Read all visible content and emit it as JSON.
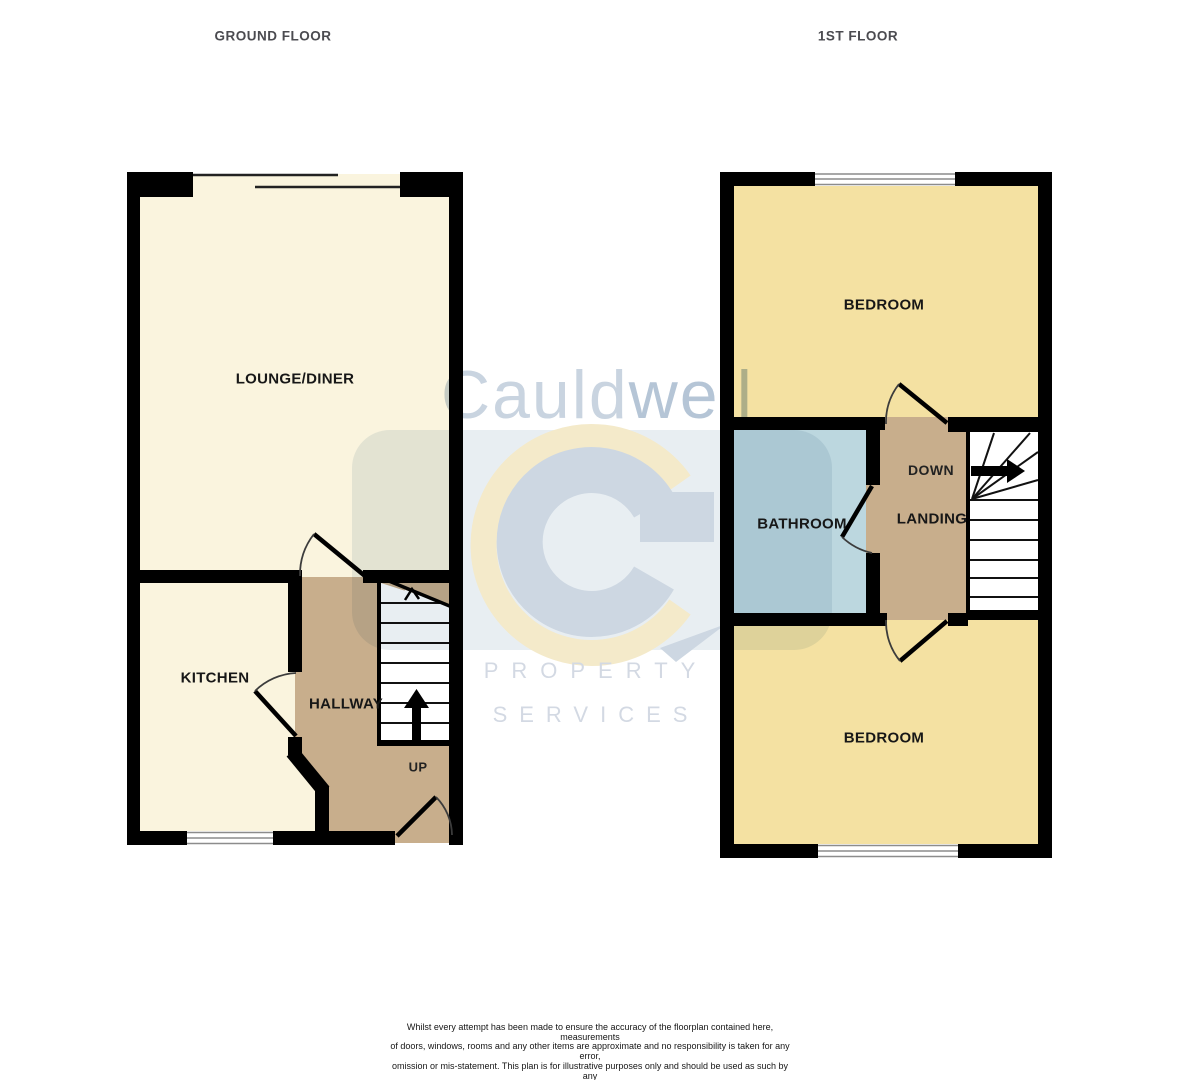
{
  "floors": {
    "ground": {
      "title": "GROUND FLOOR",
      "rooms": {
        "lounge": "LOUNGE/DINER",
        "kitchen": "KITCHEN",
        "hallway": "HALLWAY"
      },
      "stair_direction": "UP"
    },
    "first": {
      "title": "1ST FLOOR",
      "rooms": {
        "bedroom_top": "BEDROOM",
        "bathroom": "BATHROOM",
        "landing": "LANDING",
        "bedroom_bottom": "BEDROOM"
      },
      "stair_direction": "DOWN"
    }
  },
  "watermark": {
    "brand": "Cauldwell",
    "brand_part1": "Cauld",
    "brand_part2": "well",
    "caption_line1": "PROPERTY",
    "caption_line2": "SERVICES"
  },
  "disclaimer": {
    "lines": [
      "Whilst every attempt has been made to ensure the accuracy of the floorplan contained here, measurements",
      "of doors, windows, rooms and any other items are approximate and no responsibility is taken for any error,",
      "omission or mis-statement. This plan is for illustrative purposes only and should be used as such by any",
      "prospective purchaser. The services, systems and appliances shown have not been tested and no guarantee",
      "as to their operability or efficiency can be given.",
      "Made with Metropix ©2025"
    ]
  },
  "colors": {
    "wall": "#000000",
    "room_cream": "#FAF4DE",
    "room_yellow": "#F4E1A2",
    "room_tan": "#C8AE8C",
    "room_bath": "#BCD7DF",
    "stair_white": "#FFFFFF",
    "window_line": "#8C8C8C",
    "door_arc": "#3C3C3C",
    "title_text": "#4B4B50",
    "label_text": "#171717",
    "wm_brand_light": "#C9D4E0",
    "wm_brand_dark": "#B5C5D6",
    "wm_logo_blue": "#CDD7E2",
    "wm_logo_pale": "#F4EACA",
    "wm_caption_text": "#D3D9E3"
  }
}
